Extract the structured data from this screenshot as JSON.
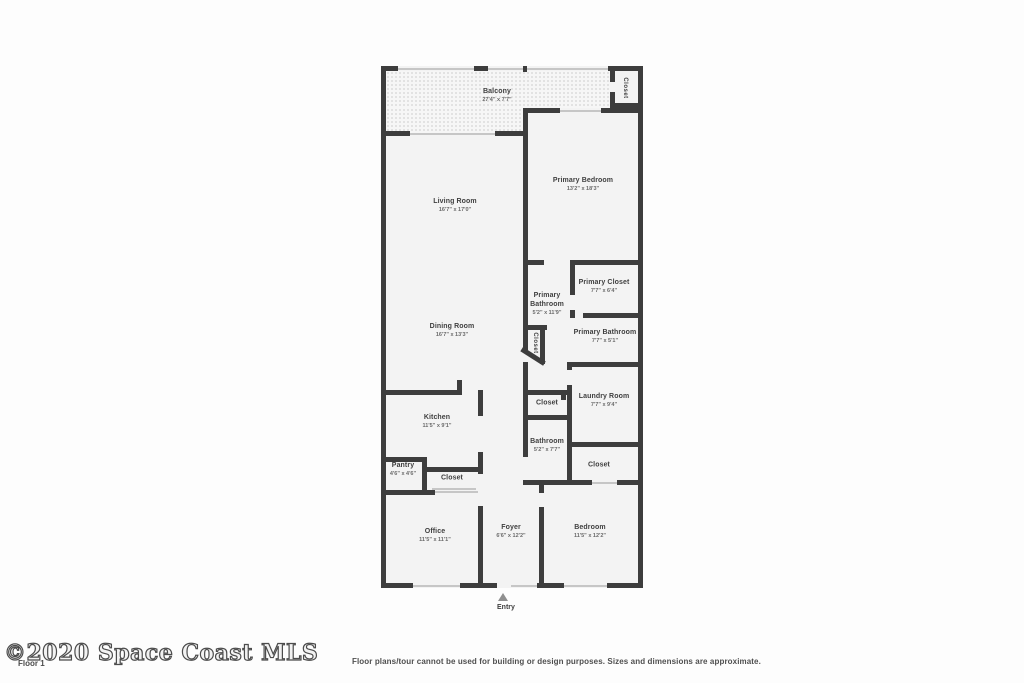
{
  "footer": {
    "watermark": "©2020 Space Coast MLS",
    "floor_label": "Floor 1",
    "disclaimer": "Floor plans/tour cannot be used for building or design purposes. Sizes and dimensions are approximate."
  },
  "plan": {
    "entry_label": "Entry",
    "wall_color": "#3d3d3d",
    "floor_color": "#f3f3f3",
    "rooms": [
      {
        "name": "Balcony",
        "dims": "27'4\" x 7'7\"",
        "x": 116,
        "y": 30
      },
      {
        "name": "Closet",
        "x": 243,
        "y": 22,
        "vertical": true
      },
      {
        "name": "Living Room",
        "dims": "16'7\" x 17'0\"",
        "x": 74,
        "y": 140
      },
      {
        "name": "Primary Bedroom",
        "dims": "13'2\" x 18'3\"",
        "x": 202,
        "y": 119
      },
      {
        "name": "Dining Room",
        "dims": "16'7\" x 13'3\"",
        "x": 71,
        "y": 265
      },
      {
        "name": "Primary|Bathroom",
        "dims": "5'2\" x 11'9\"",
        "x": 166,
        "y": 238
      },
      {
        "name": "Primary Closet",
        "dims": "7'7\" x 6'4\"",
        "x": 223,
        "y": 221
      },
      {
        "name": "Closet",
        "x": 153,
        "y": 277,
        "vertical": true
      },
      {
        "name": "Primary Bathroom",
        "dims": "7'7\" x 5'1\"",
        "x": 224,
        "y": 271
      },
      {
        "name": "Laundry Room",
        "dims": "7'7\" x 9'4\"",
        "x": 223,
        "y": 335
      },
      {
        "name": "Closet",
        "x": 166,
        "y": 338
      },
      {
        "name": "Kitchen",
        "dims": "11'5\" x 9'1\"",
        "x": 56,
        "y": 356
      },
      {
        "name": "Bathroom",
        "dims": "5'2\" x 7'7\"",
        "x": 166,
        "y": 380
      },
      {
        "name": "Closet",
        "x": 218,
        "y": 400
      },
      {
        "name": "Pantry",
        "dims": "4'6\" x 4'6\"",
        "x": 22,
        "y": 404
      },
      {
        "name": "Closet",
        "x": 71,
        "y": 413
      },
      {
        "name": "Office",
        "dims": "11'5\" x 11'1\"",
        "x": 54,
        "y": 470
      },
      {
        "name": "Foyer",
        "dims": "6'6\" x 12'2\"",
        "x": 130,
        "y": 466
      },
      {
        "name": "Bedroom",
        "dims": "11'5\" x 12'2\"",
        "x": 209,
        "y": 466
      }
    ],
    "balcony_areas": [
      [
        5,
        5,
        224,
        37
      ],
      [
        5,
        42,
        137,
        25
      ]
    ],
    "walls": [
      [
        0,
        0,
        17,
        5
      ],
      [
        93,
        0,
        14,
        5
      ],
      [
        142,
        0,
        4,
        6
      ],
      [
        227,
        0,
        35,
        5
      ],
      [
        0,
        0,
        5,
        522
      ],
      [
        257,
        0,
        5,
        522
      ],
      [
        0,
        65,
        29,
        5
      ],
      [
        114,
        65,
        33,
        5
      ],
      [
        142,
        42,
        37,
        5
      ],
      [
        220,
        42,
        42,
        5
      ],
      [
        229,
        37,
        33,
        5
      ],
      [
        229,
        4,
        5,
        12
      ],
      [
        229,
        26,
        5,
        16
      ],
      [
        142,
        42,
        5,
        220
      ],
      [
        142,
        194,
        21,
        5
      ],
      [
        189,
        194,
        73,
        5
      ],
      [
        189,
        199,
        5,
        30
      ],
      [
        189,
        244,
        5,
        8
      ],
      [
        189,
        247,
        4,
        5
      ],
      [
        202,
        247,
        60,
        5
      ],
      [
        145,
        259,
        21,
        5
      ],
      [
        159,
        259,
        5,
        39
      ],
      [
        142,
        262,
        5,
        22
      ],
      [
        142,
        296,
        5,
        28
      ],
      [
        186,
        296,
        5,
        8
      ],
      [
        186,
        319,
        5,
        100
      ],
      [
        186,
        296,
        76,
        5
      ],
      [
        186,
        376,
        76,
        5
      ],
      [
        142,
        324,
        44,
        5
      ],
      [
        142,
        349,
        44,
        5
      ],
      [
        180,
        324,
        5,
        10
      ],
      [
        142,
        324,
        5,
        30
      ],
      [
        142,
        354,
        5,
        37
      ],
      [
        142,
        414,
        69,
        5
      ],
      [
        236,
        414,
        26,
        5
      ],
      [
        158,
        414,
        5,
        13
      ],
      [
        158,
        441,
        5,
        81
      ],
      [
        5,
        324,
        72,
        5
      ],
      [
        76,
        314,
        5,
        15
      ],
      [
        97,
        324,
        5,
        26
      ],
      [
        97,
        386,
        5,
        22
      ],
      [
        97,
        440,
        5,
        82
      ],
      [
        5,
        391,
        41,
        5
      ],
      [
        41,
        391,
        5,
        37
      ],
      [
        46,
        401,
        51,
        5
      ],
      [
        5,
        424,
        49,
        5
      ],
      [
        0,
        517,
        32,
        5
      ],
      [
        79,
        517,
        37,
        5
      ],
      [
        156,
        517,
        27,
        5
      ],
      [
        226,
        517,
        36,
        5
      ]
    ],
    "thin_lines": [
      [
        17,
        2,
        76,
        2
      ],
      [
        107,
        2,
        35,
        2
      ],
      [
        146,
        2,
        81,
        2
      ],
      [
        29,
        67,
        85,
        2
      ],
      [
        179,
        44,
        41,
        2
      ],
      [
        32,
        519,
        47,
        2
      ],
      [
        130,
        519,
        26,
        2
      ],
      [
        183,
        519,
        43,
        2
      ],
      [
        51,
        422,
        44,
        2
      ],
      [
        54,
        425,
        43,
        2
      ],
      [
        211,
        416,
        25,
        2
      ]
    ],
    "diagonal": {
      "x": 142,
      "y": 281,
      "len": 27,
      "angle": 32.5
    }
  }
}
